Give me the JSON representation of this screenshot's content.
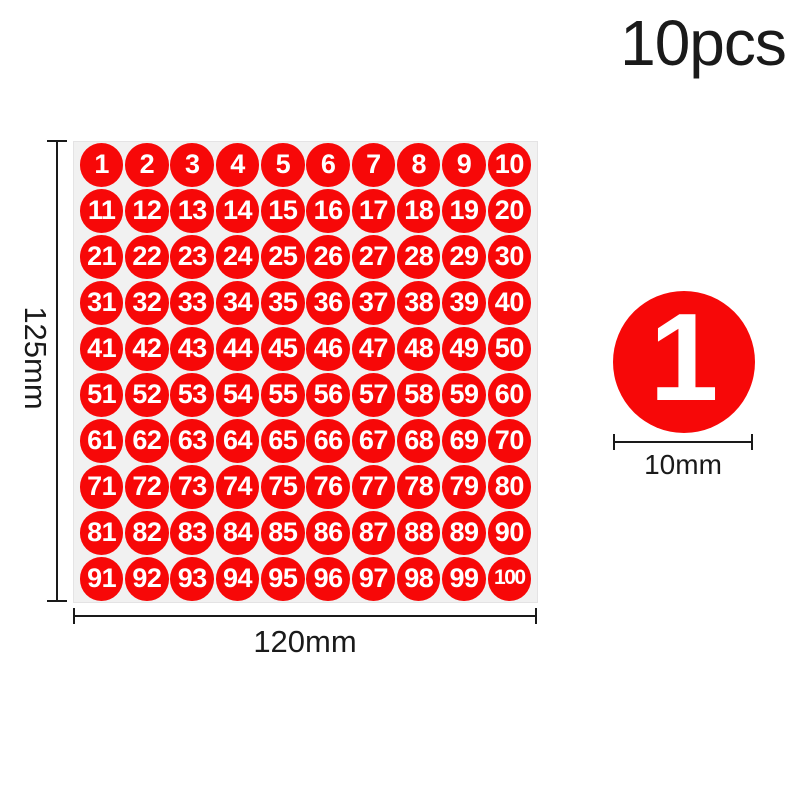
{
  "colors": {
    "sticker_red": "#f70808",
    "sheet_background": "#f1f1f1",
    "sheet_border": "#e4e3e4",
    "annotation": "#1a1a1a",
    "number_white": "#ffffff",
    "page_background": "#ffffff"
  },
  "header": {
    "quantity_label": "10pcs"
  },
  "sheet": {
    "rows": 10,
    "columns": 10,
    "height_label": "125mm",
    "width_label": "120mm",
    "stickers": [
      "1",
      "2",
      "3",
      "4",
      "5",
      "6",
      "7",
      "8",
      "9",
      "10",
      "11",
      "12",
      "13",
      "14",
      "15",
      "16",
      "17",
      "18",
      "19",
      "20",
      "21",
      "22",
      "23",
      "24",
      "25",
      "26",
      "27",
      "28",
      "29",
      "30",
      "31",
      "32",
      "33",
      "34",
      "35",
      "36",
      "37",
      "38",
      "39",
      "40",
      "41",
      "42",
      "43",
      "44",
      "45",
      "46",
      "47",
      "48",
      "49",
      "50",
      "51",
      "52",
      "53",
      "54",
      "55",
      "56",
      "57",
      "58",
      "59",
      "60",
      "61",
      "62",
      "63",
      "64",
      "65",
      "66",
      "67",
      "68",
      "69",
      "70",
      "71",
      "72",
      "73",
      "74",
      "75",
      "76",
      "77",
      "78",
      "79",
      "80",
      "81",
      "82",
      "83",
      "84",
      "85",
      "86",
      "87",
      "88",
      "89",
      "90",
      "91",
      "92",
      "93",
      "94",
      "95",
      "96",
      "97",
      "98",
      "99",
      "100"
    ]
  },
  "sample": {
    "number": "1",
    "diameter_label": "10mm"
  }
}
